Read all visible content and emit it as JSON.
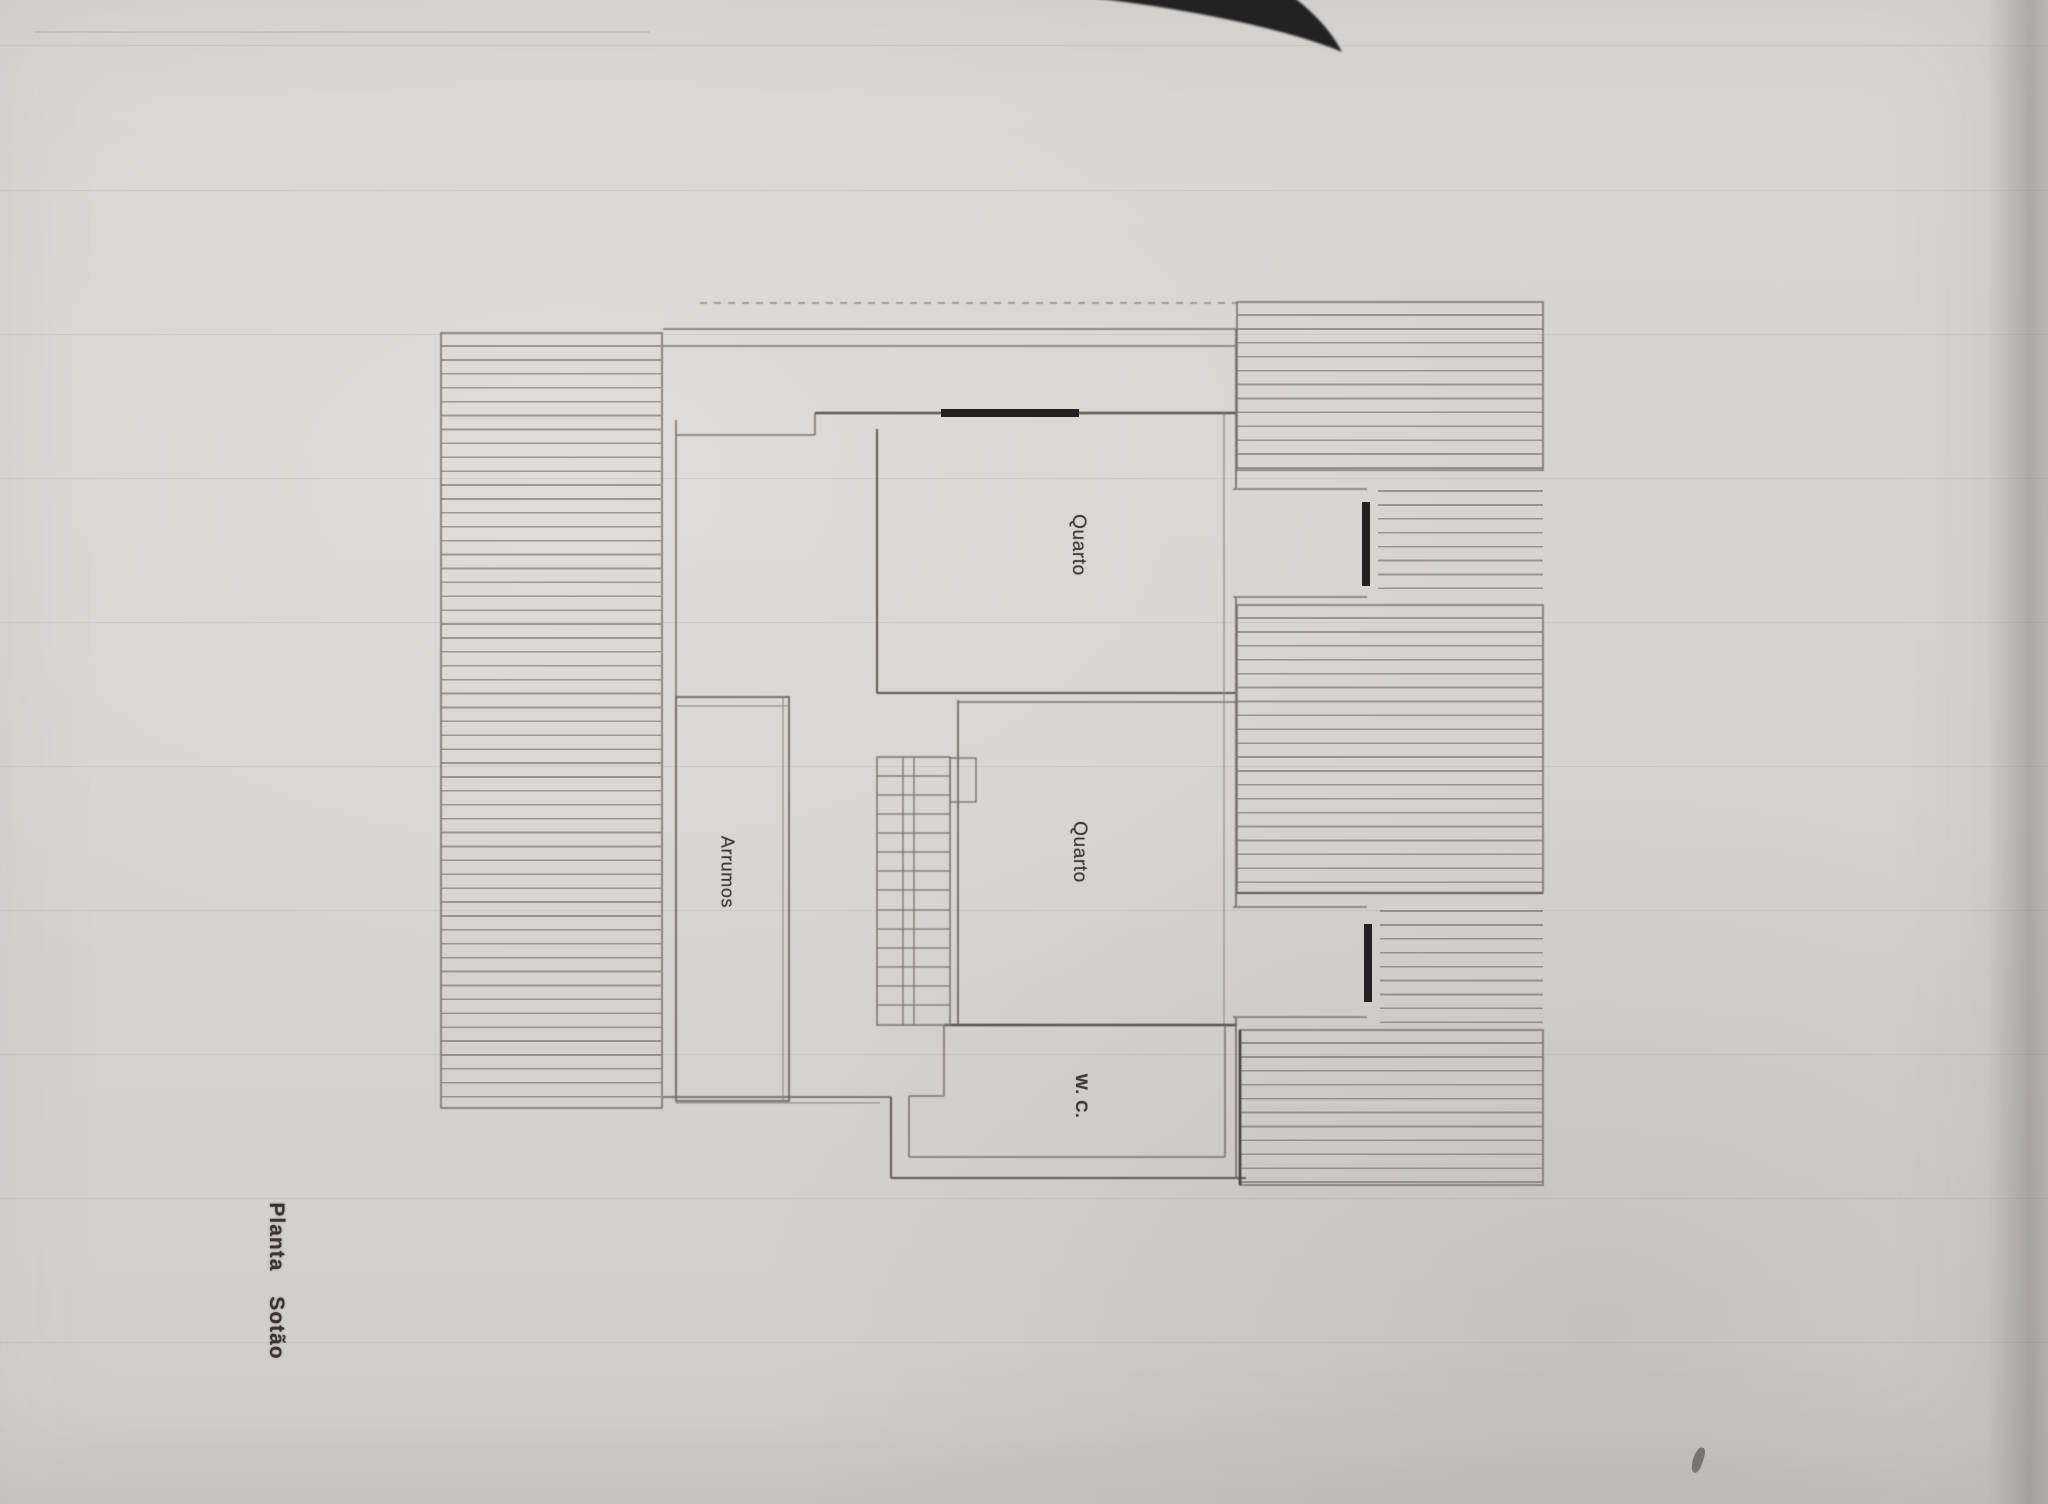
{
  "floor_plan": {
    "plan_title": "Planta Sotão",
    "rooms": {
      "bedroom_top": {
        "label": "Quarto"
      },
      "bedroom_middle": {
        "label": "Quarto"
      },
      "storage": {
        "label": "Arrumos"
      },
      "wc": {
        "label": "W. C."
      }
    },
    "colors": {
      "paper": "#d6d3cf",
      "pencil_line": "#78736c",
      "dark_wall": "#57524b",
      "window_marker": "#23211f",
      "scanner_artifact_black": "#242220"
    }
  }
}
